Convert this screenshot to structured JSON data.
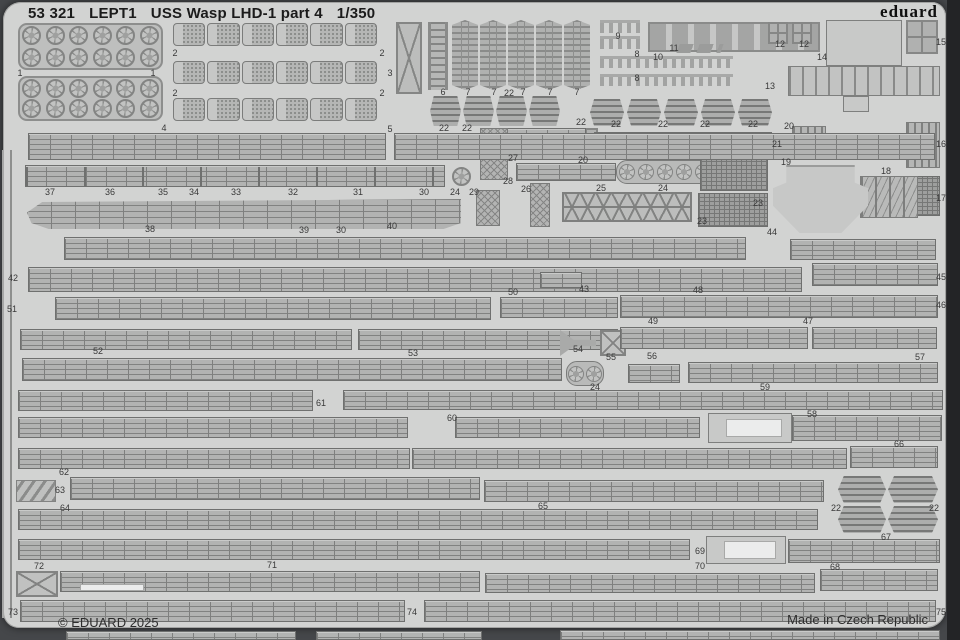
{
  "header": {
    "catalog": "53 321",
    "code": "LEPT1",
    "title": "USS Wasp LHD-1 part 4",
    "scale": "1/350",
    "brand": "eduard"
  },
  "footer": {
    "copyright": "© EDUARD 2025",
    "origin": "Made in Czech Republic"
  },
  "colors": {
    "sheet": "#d2d3d2",
    "part_fill": "#b2b3b2",
    "part_line": "#6f706f",
    "outside": "#45474a",
    "text": "#1b1b1b"
  },
  "labels": [
    {
      "t": "1",
      "x": 20,
      "y": 73
    },
    {
      "t": "1",
      "x": 153,
      "y": 73
    },
    {
      "t": "2",
      "x": 175,
      "y": 53
    },
    {
      "t": "2",
      "x": 382,
      "y": 53
    },
    {
      "t": "2",
      "x": 175,
      "y": 93
    },
    {
      "t": "2",
      "x": 382,
      "y": 93
    },
    {
      "t": "3",
      "x": 390,
      "y": 73
    },
    {
      "t": "4",
      "x": 164,
      "y": 128
    },
    {
      "t": "5",
      "x": 390,
      "y": 129
    },
    {
      "t": "6",
      "x": 443,
      "y": 92
    },
    {
      "t": "7",
      "x": 468,
      "y": 92
    },
    {
      "t": "7",
      "x": 494,
      "y": 92
    },
    {
      "t": "22",
      "x": 509,
      "y": 93
    },
    {
      "t": "7",
      "x": 523,
      "y": 92
    },
    {
      "t": "7",
      "x": 550,
      "y": 92
    },
    {
      "t": "7",
      "x": 577,
      "y": 92
    },
    {
      "t": "9",
      "x": 618,
      "y": 36
    },
    {
      "t": "8",
      "x": 637,
      "y": 54
    },
    {
      "t": "8",
      "x": 637,
      "y": 78
    },
    {
      "t": "10",
      "x": 658,
      "y": 57
    },
    {
      "t": "11",
      "x": 674,
      "y": 48
    },
    {
      "t": "12",
      "x": 780,
      "y": 44
    },
    {
      "t": "12",
      "x": 804,
      "y": 44
    },
    {
      "t": "13",
      "x": 770,
      "y": 86
    },
    {
      "t": "14",
      "x": 822,
      "y": 57
    },
    {
      "t": "15",
      "x": 941,
      "y": 42
    },
    {
      "t": "22",
      "x": 444,
      "y": 128
    },
    {
      "t": "22",
      "x": 467,
      "y": 128
    },
    {
      "t": "22",
      "x": 581,
      "y": 122
    },
    {
      "t": "22",
      "x": 616,
      "y": 124
    },
    {
      "t": "22",
      "x": 663,
      "y": 124
    },
    {
      "t": "22",
      "x": 705,
      "y": 124
    },
    {
      "t": "22",
      "x": 753,
      "y": 124
    },
    {
      "t": "20",
      "x": 789,
      "y": 126
    },
    {
      "t": "21",
      "x": 777,
      "y": 144
    },
    {
      "t": "16",
      "x": 941,
      "y": 144
    },
    {
      "t": "27",
      "x": 513,
      "y": 158
    },
    {
      "t": "20",
      "x": 583,
      "y": 160
    },
    {
      "t": "19",
      "x": 786,
      "y": 162
    },
    {
      "t": "18",
      "x": 886,
      "y": 171
    },
    {
      "t": "17",
      "x": 941,
      "y": 198
    },
    {
      "t": "28",
      "x": 508,
      "y": 181
    },
    {
      "t": "26",
      "x": 526,
      "y": 189
    },
    {
      "t": "25",
      "x": 601,
      "y": 188
    },
    {
      "t": "24",
      "x": 663,
      "y": 188
    },
    {
      "t": "23",
      "x": 758,
      "y": 203
    },
    {
      "t": "23",
      "x": 702,
      "y": 221
    },
    {
      "t": "37",
      "x": 50,
      "y": 192
    },
    {
      "t": "36",
      "x": 110,
      "y": 192
    },
    {
      "t": "35",
      "x": 163,
      "y": 192
    },
    {
      "t": "34",
      "x": 194,
      "y": 192
    },
    {
      "t": "33",
      "x": 236,
      "y": 192
    },
    {
      "t": "32",
      "x": 293,
      "y": 192
    },
    {
      "t": "31",
      "x": 358,
      "y": 192
    },
    {
      "t": "30",
      "x": 424,
      "y": 192
    },
    {
      "t": "24",
      "x": 455,
      "y": 192
    },
    {
      "t": "29",
      "x": 474,
      "y": 192
    },
    {
      "t": "38",
      "x": 150,
      "y": 229
    },
    {
      "t": "39",
      "x": 304,
      "y": 230
    },
    {
      "t": "30",
      "x": 341,
      "y": 230
    },
    {
      "t": "40",
      "x": 392,
      "y": 226
    },
    {
      "t": "44",
      "x": 772,
      "y": 232
    },
    {
      "t": "42",
      "x": 13,
      "y": 278
    },
    {
      "t": "45",
      "x": 941,
      "y": 277
    },
    {
      "t": "50",
      "x": 513,
      "y": 292
    },
    {
      "t": "43",
      "x": 584,
      "y": 289
    },
    {
      "t": "48",
      "x": 698,
      "y": 290
    },
    {
      "t": "51",
      "x": 12,
      "y": 309
    },
    {
      "t": "46",
      "x": 941,
      "y": 305
    },
    {
      "t": "49",
      "x": 653,
      "y": 321
    },
    {
      "t": "47",
      "x": 808,
      "y": 321
    },
    {
      "t": "52",
      "x": 98,
      "y": 351
    },
    {
      "t": "53",
      "x": 413,
      "y": 353
    },
    {
      "t": "54",
      "x": 578,
      "y": 349
    },
    {
      "t": "55",
      "x": 611,
      "y": 357
    },
    {
      "t": "56",
      "x": 652,
      "y": 356
    },
    {
      "t": "57",
      "x": 920,
      "y": 357
    },
    {
      "t": "24",
      "x": 595,
      "y": 387
    },
    {
      "t": "59",
      "x": 765,
      "y": 387
    },
    {
      "t": "61",
      "x": 321,
      "y": 403
    },
    {
      "t": "60",
      "x": 452,
      "y": 418
    },
    {
      "t": "58",
      "x": 812,
      "y": 414
    },
    {
      "t": "66",
      "x": 899,
      "y": 444
    },
    {
      "t": "62",
      "x": 64,
      "y": 472
    },
    {
      "t": "63",
      "x": 60,
      "y": 490
    },
    {
      "t": "64",
      "x": 65,
      "y": 508
    },
    {
      "t": "65",
      "x": 543,
      "y": 506
    },
    {
      "t": "22",
      "x": 836,
      "y": 508
    },
    {
      "t": "22",
      "x": 934,
      "y": 508
    },
    {
      "t": "67",
      "x": 886,
      "y": 537
    },
    {
      "t": "69",
      "x": 700,
      "y": 551
    },
    {
      "t": "70",
      "x": 700,
      "y": 566
    },
    {
      "t": "71",
      "x": 272,
      "y": 565
    },
    {
      "t": "72",
      "x": 39,
      "y": 566
    },
    {
      "t": "68",
      "x": 835,
      "y": 567
    },
    {
      "t": "73",
      "x": 13,
      "y": 612
    },
    {
      "t": "74",
      "x": 412,
      "y": 612
    },
    {
      "t": "75",
      "x": 941,
      "y": 612
    }
  ],
  "parts": [
    {
      "k": "wheels",
      "x": 18,
      "y": 23,
      "w": 145,
      "h": 47
    },
    {
      "k": "wheels",
      "x": 18,
      "y": 76,
      "w": 145,
      "h": 45
    },
    {
      "k": "trucks",
      "x": 172,
      "y": 22,
      "w": 206,
      "h": 25
    },
    {
      "k": "trucks",
      "x": 172,
      "y": 60,
      "w": 206,
      "h": 25
    },
    {
      "k": "trucks",
      "x": 172,
      "y": 97,
      "w": 206,
      "h": 25
    },
    {
      "k": "xframe",
      "x": 396,
      "y": 22,
      "w": 26,
      "h": 72
    },
    {
      "k": "vladder",
      "x": 428,
      "y": 22,
      "w": 20,
      "h": 68
    },
    {
      "k": "acc",
      "x": 452,
      "y": 20,
      "w": 26,
      "h": 70
    },
    {
      "k": "acc",
      "x": 480,
      "y": 20,
      "w": 26,
      "h": 70
    },
    {
      "k": "acc",
      "x": 508,
      "y": 20,
      "w": 26,
      "h": 70
    },
    {
      "k": "acc",
      "x": 536,
      "y": 20,
      "w": 26,
      "h": 70
    },
    {
      "k": "acc",
      "x": 564,
      "y": 20,
      "w": 26,
      "h": 70
    },
    {
      "k": "clips",
      "x": 600,
      "y": 20,
      "w": 40,
      "h": 13
    },
    {
      "k": "clips",
      "x": 600,
      "y": 36,
      "w": 40,
      "h": 13
    },
    {
      "k": "clips",
      "x": 600,
      "y": 56,
      "w": 133,
      "h": 12
    },
    {
      "k": "clips",
      "x": 600,
      "y": 74,
      "w": 133,
      "h": 12
    },
    {
      "k": "pockets",
      "x": 648,
      "y": 22,
      "w": 172,
      "h": 30
    },
    {
      "k": "chev",
      "x": 678,
      "y": 44,
      "w": 44,
      "h": 9
    },
    {
      "k": "grid4",
      "x": 768,
      "y": 22,
      "w": 20,
      "h": 22
    },
    {
      "k": "grid4",
      "x": 792,
      "y": 22,
      "w": 20,
      "h": 22
    },
    {
      "k": "plain",
      "x": 826,
      "y": 20,
      "w": 76,
      "h": 46
    },
    {
      "k": "slats",
      "x": 788,
      "y": 66,
      "w": 152,
      "h": 30
    },
    {
      "k": "plain",
      "x": 843,
      "y": 96,
      "w": 26,
      "h": 16
    },
    {
      "k": "grid4",
      "x": 906,
      "y": 20,
      "w": 32,
      "h": 34
    },
    {
      "k": "vslats",
      "x": 906,
      "y": 122,
      "w": 34,
      "h": 46
    },
    {
      "k": "densegrid",
      "x": 916,
      "y": 176,
      "w": 24,
      "h": 40
    },
    {
      "k": "towers",
      "x": 860,
      "y": 176,
      "w": 58,
      "h": 42
    },
    {
      "k": "funnel",
      "x": 773,
      "y": 165,
      "w": 95,
      "h": 68
    },
    {
      "k": "raft",
      "x": 430,
      "y": 96,
      "w": 31,
      "h": 30
    },
    {
      "k": "raft",
      "x": 463,
      "y": 96,
      "w": 31,
      "h": 30
    },
    {
      "k": "raft",
      "x": 496,
      "y": 96,
      "w": 31,
      "h": 30
    },
    {
      "k": "raft",
      "x": 529,
      "y": 96,
      "w": 31,
      "h": 30
    },
    {
      "k": "raft",
      "x": 590,
      "y": 99,
      "w": 34,
      "h": 27
    },
    {
      "k": "raft",
      "x": 627,
      "y": 99,
      "w": 34,
      "h": 27
    },
    {
      "k": "raft",
      "x": 664,
      "y": 99,
      "w": 34,
      "h": 27
    },
    {
      "k": "raft",
      "x": 701,
      "y": 99,
      "w": 34,
      "h": 27
    },
    {
      "k": "raft",
      "x": 738,
      "y": 99,
      "w": 34,
      "h": 27
    },
    {
      "k": "grid4",
      "x": 574,
      "y": 128,
      "w": 24,
      "h": 26
    },
    {
      "k": "vslats",
      "x": 792,
      "y": 126,
      "w": 34,
      "h": 14
    },
    {
      "k": "rail",
      "x": 594,
      "y": 132,
      "w": 178,
      "h": 24
    },
    {
      "k": "rail",
      "x": 504,
      "y": 128,
      "w": 82,
      "h": 26
    },
    {
      "k": "lattice",
      "x": 480,
      "y": 128,
      "w": 28,
      "h": 52
    },
    {
      "k": "rail",
      "x": 516,
      "y": 163,
      "w": 100,
      "h": 18
    },
    {
      "k": "lattice",
      "x": 530,
      "y": 183,
      "w": 20,
      "h": 44
    },
    {
      "k": "truss",
      "x": 562,
      "y": 192,
      "w": 130,
      "h": 30
    },
    {
      "k": "circles",
      "x": 616,
      "y": 160,
      "w": 98,
      "h": 24,
      "n": 5
    },
    {
      "k": "densegrid",
      "x": 700,
      "y": 155,
      "w": 68,
      "h": 36
    },
    {
      "k": "densegrid",
      "x": 698,
      "y": 193,
      "w": 70,
      "h": 34
    },
    {
      "k": "rail",
      "x": 28,
      "y": 133,
      "w": 358,
      "h": 27
    },
    {
      "k": "rail",
      "x": 394,
      "y": 133,
      "w": 541,
      "h": 27
    },
    {
      "k": "railseg",
      "x": 25,
      "y": 165,
      "w": 420,
      "h": 22
    },
    {
      "k": "wheel1",
      "x": 447,
      "y": 164,
      "w": 28,
      "h": 24
    },
    {
      "k": "lattice",
      "x": 476,
      "y": 190,
      "w": 24,
      "h": 36
    },
    {
      "k": "hull",
      "x": 27,
      "y": 199,
      "w": 434,
      "h": 30
    },
    {
      "k": "rail",
      "x": 64,
      "y": 237,
      "w": 682,
      "h": 23
    },
    {
      "k": "rail",
      "x": 790,
      "y": 239,
      "w": 146,
      "h": 21
    },
    {
      "k": "rail",
      "x": 28,
      "y": 267,
      "w": 774,
      "h": 25
    },
    {
      "k": "rail",
      "x": 812,
      "y": 263,
      "w": 126,
      "h": 23
    },
    {
      "k": "rail",
      "x": 540,
      "y": 272,
      "w": 42,
      "h": 16
    },
    {
      "k": "rail",
      "x": 55,
      "y": 297,
      "w": 436,
      "h": 23
    },
    {
      "k": "rail",
      "x": 500,
      "y": 297,
      "w": 118,
      "h": 21
    },
    {
      "k": "rail",
      "x": 620,
      "y": 295,
      "w": 318,
      "h": 23
    },
    {
      "k": "rail",
      "x": 20,
      "y": 329,
      "w": 332,
      "h": 21
    },
    {
      "k": "rail",
      "x": 358,
      "y": 329,
      "w": 260,
      "h": 21
    },
    {
      "k": "arrow",
      "x": 560,
      "y": 330,
      "w": 36,
      "h": 26
    },
    {
      "k": "xbox",
      "x": 600,
      "y": 330,
      "w": 26,
      "h": 26
    },
    {
      "k": "rail",
      "x": 620,
      "y": 327,
      "w": 188,
      "h": 22
    },
    {
      "k": "rail",
      "x": 812,
      "y": 327,
      "w": 125,
      "h": 22
    },
    {
      "k": "rail",
      "x": 22,
      "y": 358,
      "w": 540,
      "h": 23
    },
    {
      "k": "circles",
      "x": 566,
      "y": 361,
      "w": 38,
      "h": 25,
      "n": 2
    },
    {
      "k": "rail",
      "x": 628,
      "y": 364,
      "w": 52,
      "h": 19
    },
    {
      "k": "rail",
      "x": 688,
      "y": 362,
      "w": 250,
      "h": 21
    },
    {
      "k": "white",
      "x": 848,
      "y": 397,
      "w": 46,
      "h": 8
    },
    {
      "k": "rail",
      "x": 18,
      "y": 390,
      "w": 295,
      "h": 21
    },
    {
      "k": "rail",
      "x": 343,
      "y": 390,
      "w": 600,
      "h": 20
    },
    {
      "k": "rail",
      "x": 18,
      "y": 417,
      "w": 390,
      "h": 21
    },
    {
      "k": "rail",
      "x": 455,
      "y": 417,
      "w": 245,
      "h": 21
    },
    {
      "k": "plain",
      "x": 708,
      "y": 413,
      "w": 84,
      "h": 30
    },
    {
      "k": "white",
      "x": 726,
      "y": 419,
      "w": 56,
      "h": 18
    },
    {
      "k": "rail",
      "x": 792,
      "y": 415,
      "w": 150,
      "h": 26
    },
    {
      "k": "rail",
      "x": 18,
      "y": 448,
      "w": 392,
      "h": 21
    },
    {
      "k": "rail",
      "x": 412,
      "y": 448,
      "w": 435,
      "h": 21
    },
    {
      "k": "rail",
      "x": 850,
      "y": 446,
      "w": 88,
      "h": 22
    },
    {
      "k": "zpart",
      "x": 16,
      "y": 480,
      "w": 40,
      "h": 22
    },
    {
      "k": "rail",
      "x": 70,
      "y": 477,
      "w": 410,
      "h": 23
    },
    {
      "k": "rail",
      "x": 484,
      "y": 480,
      "w": 340,
      "h": 22
    },
    {
      "k": "raft",
      "x": 838,
      "y": 476,
      "w": 48,
      "h": 27
    },
    {
      "k": "raft",
      "x": 888,
      "y": 476,
      "w": 50,
      "h": 27
    },
    {
      "k": "raft",
      "x": 838,
      "y": 506,
      "w": 48,
      "h": 27
    },
    {
      "k": "raft",
      "x": 888,
      "y": 506,
      "w": 50,
      "h": 27
    },
    {
      "k": "rail",
      "x": 18,
      "y": 509,
      "w": 800,
      "h": 21
    },
    {
      "k": "rail",
      "x": 18,
      "y": 539,
      "w": 672,
      "h": 21
    },
    {
      "k": "plain",
      "x": 706,
      "y": 536,
      "w": 80,
      "h": 28
    },
    {
      "k": "white",
      "x": 724,
      "y": 541,
      "w": 52,
      "h": 18
    },
    {
      "k": "rail",
      "x": 788,
      "y": 539,
      "w": 152,
      "h": 24
    },
    {
      "k": "xbox",
      "x": 16,
      "y": 571,
      "w": 42,
      "h": 26
    },
    {
      "k": "rail",
      "x": 60,
      "y": 571,
      "w": 420,
      "h": 21
    },
    {
      "k": "white",
      "x": 80,
      "y": 584,
      "w": 64,
      "h": 7
    },
    {
      "k": "rail",
      "x": 485,
      "y": 573,
      "w": 330,
      "h": 20
    },
    {
      "k": "rail",
      "x": 820,
      "y": 569,
      "w": 118,
      "h": 22
    },
    {
      "k": "rail",
      "x": 20,
      "y": 600,
      "w": 385,
      "h": 22
    },
    {
      "k": "rail",
      "x": 424,
      "y": 600,
      "w": 512,
      "h": 22
    },
    {
      "k": "rail",
      "x": 66,
      "y": 631,
      "w": 230,
      "h": 9
    },
    {
      "k": "rail",
      "x": 316,
      "y": 631,
      "w": 166,
      "h": 9
    },
    {
      "k": "rail",
      "x": 560,
      "y": 630,
      "w": 380,
      "h": 10
    },
    {
      "k": "frame",
      "x": 2,
      "y": 150,
      "w": 10,
      "h": 468
    }
  ]
}
